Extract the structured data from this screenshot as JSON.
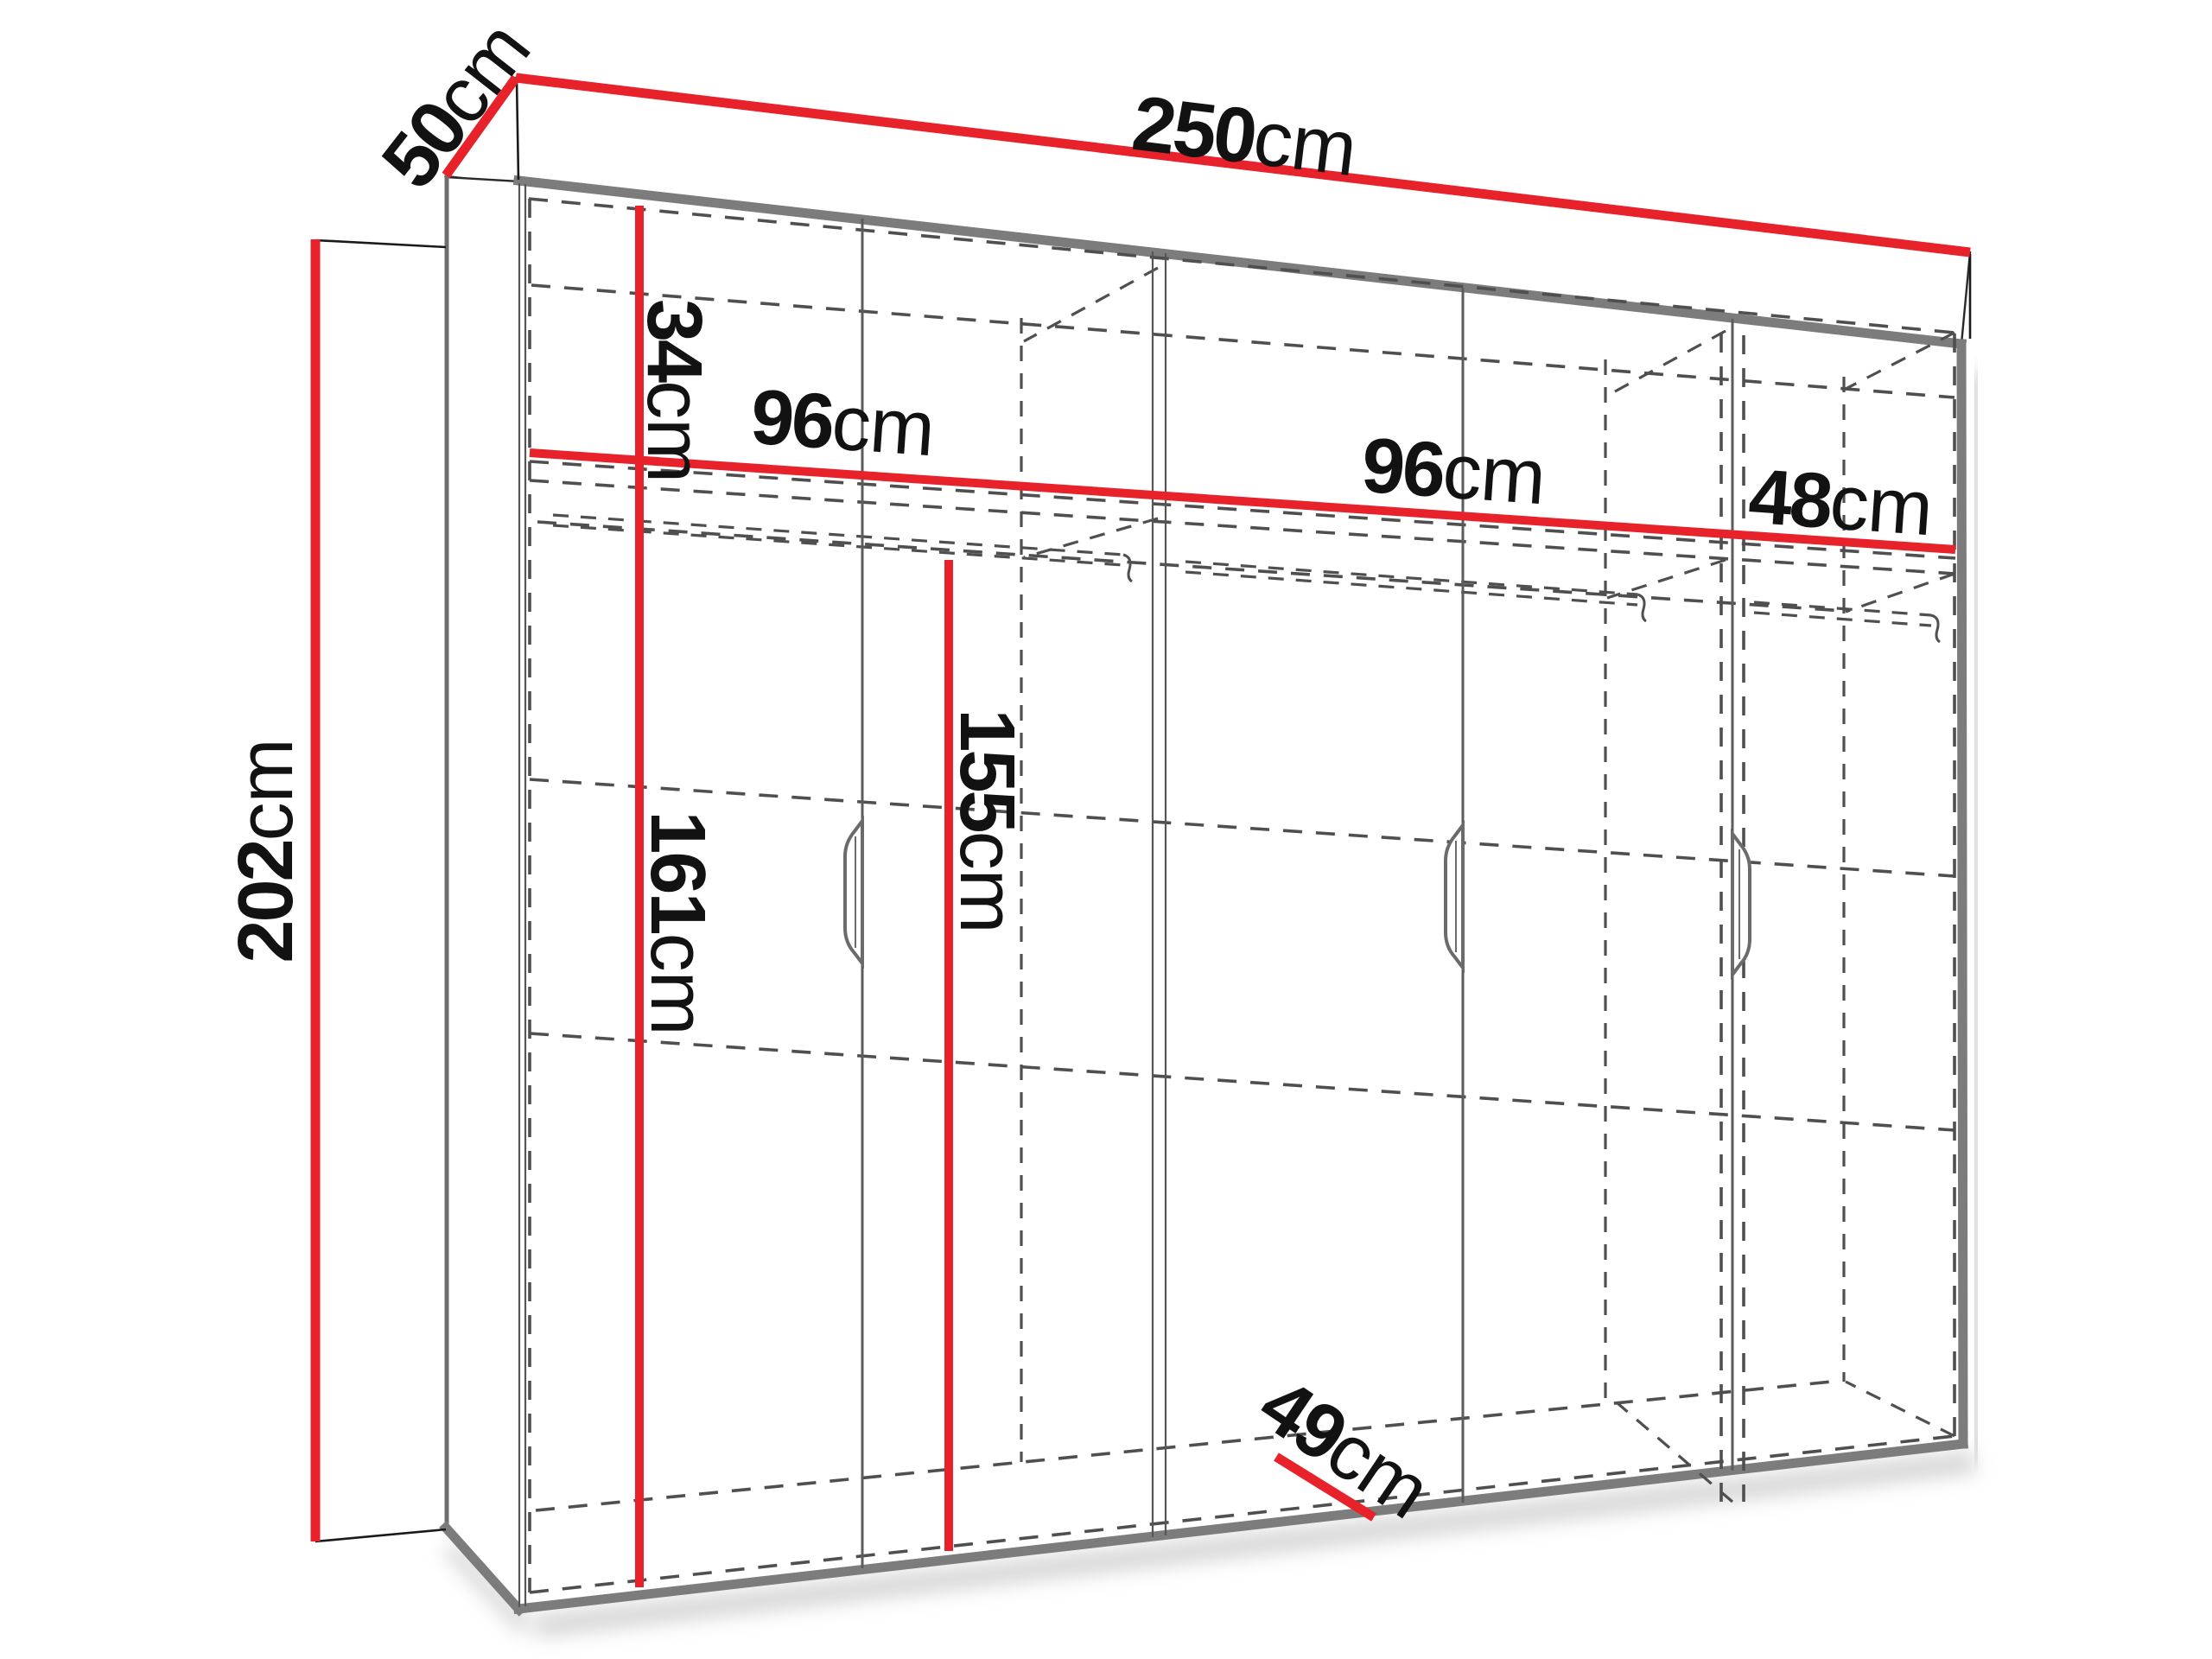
{
  "title": "Wardrobe dimension diagram",
  "colors": {
    "accent_red": "#e8222a",
    "outline_gray": "#7c7c7c",
    "dashed_gray": "#4f4f4f",
    "text_color": "#121212",
    "background": "#ffffff"
  },
  "dimensions": {
    "width": {
      "value": "250",
      "unit": "cm"
    },
    "depth": {
      "value": "50",
      "unit": "cm"
    },
    "height": {
      "value": "202",
      "unit": "cm"
    },
    "top_compartment": {
      "value": "34",
      "unit": "cm"
    },
    "section1_width": {
      "value": "96",
      "unit": "cm"
    },
    "section2_width": {
      "value": "96",
      "unit": "cm"
    },
    "section3_width": {
      "value": "48",
      "unit": "cm"
    },
    "left_interior_height": {
      "value": "161",
      "unit": "cm"
    },
    "inner_door_height": {
      "value": "155",
      "unit": "cm"
    },
    "interior_depth": {
      "value": "49",
      "unit": "cm"
    }
  }
}
